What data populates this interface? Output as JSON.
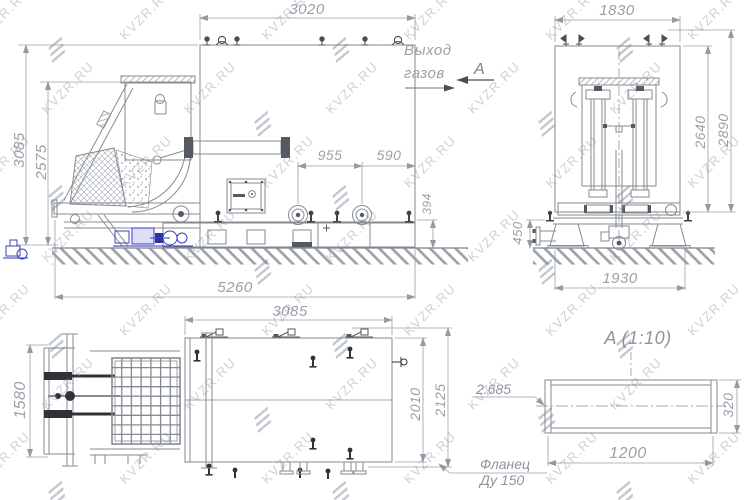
{
  "watermark": {
    "text": "KVZR.RU"
  },
  "views": {
    "side": {
      "dims": {
        "top_width": "3020",
        "height_outer": "3085",
        "height_inner": "2575",
        "flange_span": "955",
        "flange_to_edge": "590",
        "nozzle_height": "394",
        "overall_length": "5260"
      },
      "labels": {
        "gas_outlet_line1": "Выход",
        "gas_outlet_line2": "газов",
        "section_mark": "A"
      }
    },
    "front": {
      "dims": {
        "top_width": "1830",
        "height_inner": "2640",
        "height_outer": "2890",
        "flange_height": "450",
        "base_width": "1930"
      }
    },
    "plan": {
      "dims": {
        "top_width": "3085",
        "left_height": "1580",
        "right_inner": "2010",
        "right_outer": "2125"
      }
    },
    "detail": {
      "title": "A (1:10)",
      "dims": {
        "width": "1200",
        "height": "320"
      },
      "note": "2.685",
      "flange_note_line1": "Фланец",
      "flange_note_line2": "Ду 150"
    }
  }
}
